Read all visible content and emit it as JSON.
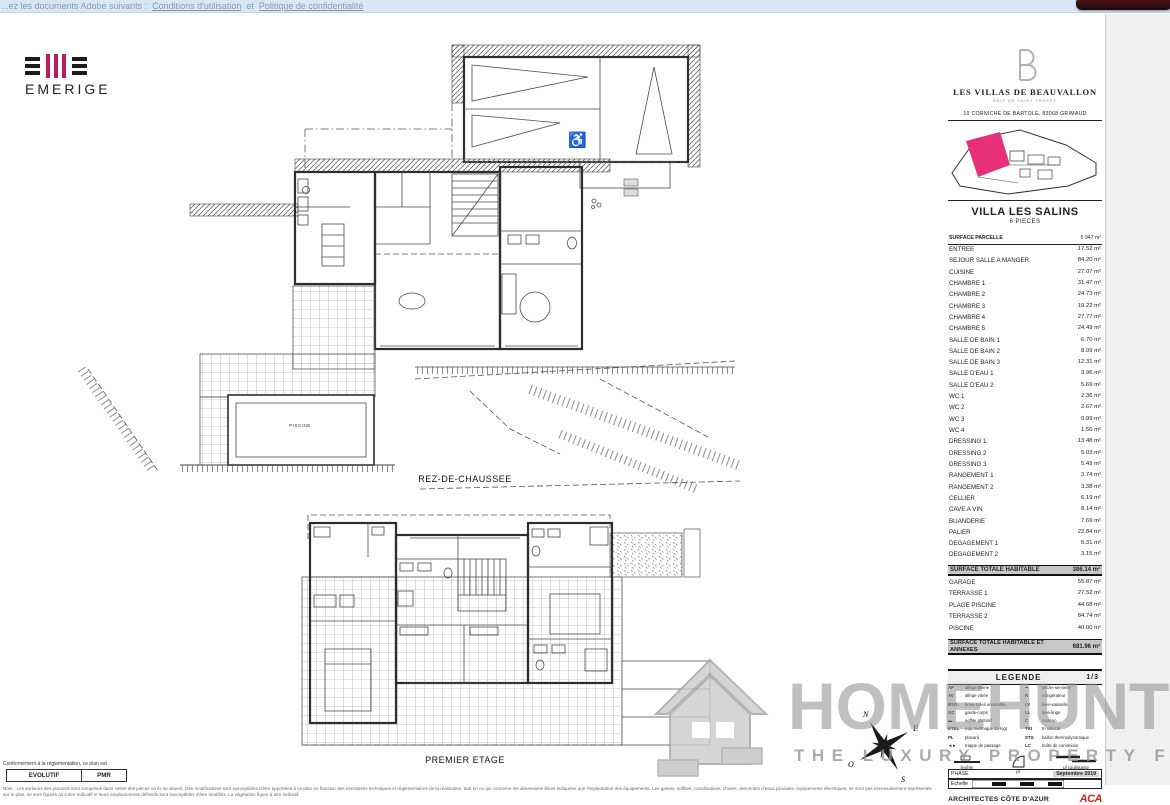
{
  "colors": {
    "accent_pink": "#c0195f",
    "lot_pink": "#e8307a",
    "watermark_gray": "#8c8c8c",
    "topbar_blue": "#d8e7f6",
    "aca_red": "#bc3026"
  },
  "browser_bar": {
    "prefix": "...ez les documents Adobe suivants :",
    "link1": "Conditions d'utilisation",
    "separator": "et",
    "link2": "Politique de confidentialité"
  },
  "emerige": {
    "name": "EMERIGE"
  },
  "plans": {
    "ground_floor_label": "REZ-DE-CHAUSSEE",
    "first_floor_label": "PREMIER ETAGE",
    "pool_label": "PISCINE",
    "compass_points": {
      "n": "N",
      "e": "E",
      "s": "S",
      "o": "O"
    }
  },
  "panel": {
    "brand": "LES VILLAS DE BEAUVALLON",
    "brand_sub": "BAIE DE SAINT TROPEZ",
    "address": "10 CORNICHE DE BARTOLE, 83068 GRIMAUD",
    "villa_name": "VILLA LES SALINS",
    "villa_type": "6 PIECES",
    "parcel": {
      "label": "SURFACE PARCELLE",
      "value": "5 947 m²"
    },
    "rooms": [
      {
        "label": "ENTREE",
        "value": "17.52 m²"
      },
      {
        "label": "SEJOUR SALLE A MANGER",
        "value": "84.20 m²"
      },
      {
        "label": "CUISINE",
        "value": "27.07 m²"
      },
      {
        "label": "CHAMBRE 1",
        "value": "31.47 m²"
      },
      {
        "label": "CHAMBRE 2",
        "value": "24.73 m²"
      },
      {
        "label": "CHAMBRE 3",
        "value": "19.22 m²"
      },
      {
        "label": "CHAMBRE 4",
        "value": "27.77 m²"
      },
      {
        "label": "CHAMBRE 5",
        "value": "24.49 m²"
      },
      {
        "label": "SALLE DE BAIN 1",
        "value": "6.70 m²"
      },
      {
        "label": "SALLE DE BAIN 2",
        "value": "8.09 m²"
      },
      {
        "label": "SALLE DE BAIN 3",
        "value": "12.31 m²"
      },
      {
        "label": "SALLE D'EAU 1",
        "value": "3.96 m²"
      },
      {
        "label": "SALLE D'EAU 2",
        "value": "5.69 m²"
      },
      {
        "label": "WC 1",
        "value": "2.36 m²"
      },
      {
        "label": "WC 2",
        "value": "2.67 m²"
      },
      {
        "label": "WC 3",
        "value": "0.99 m²"
      },
      {
        "label": "WC 4",
        "value": "1.56 m²"
      },
      {
        "label": "DRESSING 1",
        "value": "13.48 m²"
      },
      {
        "label": "DRESSING 2",
        "value": "5.03 m²"
      },
      {
        "label": "DRESSING 3",
        "value": "5.49 m²"
      },
      {
        "label": "RANGEMENT 1",
        "value": "3.74 m²"
      },
      {
        "label": "RANGEMENT 2",
        "value": "3.38 m²"
      },
      {
        "label": "CELLIER",
        "value": "6.19 m²"
      },
      {
        "label": "CAVE A VIN",
        "value": "8.14 m²"
      },
      {
        "label": "BUANDERIE",
        "value": "7.69 m²"
      },
      {
        "label": "PALIER",
        "value": "22.84 m²"
      },
      {
        "label": "DEGAGEMENT 1",
        "value": "5.31 m²"
      },
      {
        "label": "DEGAGEMENT 2",
        "value": "3.15 m²"
      }
    ],
    "total_habitable": {
      "label": "SURFACE TOTALE HABITABLE",
      "value": "386.14 m²"
    },
    "annexes": [
      {
        "label": "GARAGE",
        "value": "55.87 m²"
      },
      {
        "label": "TERRASSE 1",
        "value": "27.52 m²"
      },
      {
        "label": "PLAGE PISCINE",
        "value": "44.68 m²"
      },
      {
        "label": "TERRASSE 2",
        "value": "84.74 m²"
      },
      {
        "label": "PISCINE",
        "value": "40.00 m²"
      }
    ],
    "total_all": {
      "label": "SURFACE TOTALE HABITABLE ET ANNEXES",
      "value": "681.96 m²"
    },
    "legend": {
      "title": "LEGENDE",
      "page": "1/3",
      "left": [
        {
          "abbr": "AP",
          "label": "allège pleine"
        },
        {
          "abbr": "AV",
          "label": "allège vitrée"
        },
        {
          "abbr": "BSO",
          "label": "brise-soleil orientable"
        },
        {
          "abbr": "GC",
          "label": "garde-corps"
        },
        {
          "abbr": "▬",
          "label": "soffite plafond"
        },
        {
          "abbr": "ETEL",
          "label": "esp. technique du logt"
        },
        {
          "abbr": "PL",
          "label": "placard"
        },
        {
          "abbr": "◄►",
          "label": "trappe de passage"
        }
      ],
      "right": [
        {
          "abbr": "━",
          "label": "sèche-serviette"
        },
        {
          "abbr": "R",
          "label": "réfrigérateur"
        },
        {
          "abbr": "LV",
          "label": "lave-vaisselle"
        },
        {
          "abbr": "LL",
          "label": "lave-linge"
        },
        {
          "abbr": "C",
          "label": "cuisson"
        },
        {
          "abbr": "TRI",
          "label": "tri sélectif"
        },
        {
          "abbr": "STG",
          "label": "ballon thermodynamique"
        },
        {
          "abbr": "LC",
          "label": "boîte de connexion"
        }
      ],
      "symbols": [
        "fenêtre",
        "pf",
        "pf coulissante"
      ],
      "phase_label": "PHASE",
      "phase_value": "Septembre 2019",
      "scale_label": "Echelle",
      "architects": "ARCHITECTES CÔTE D'AZUR",
      "architects_logo": "ACA"
    }
  },
  "footer": {
    "conformity": "Conformément à la réglementation, ce plan est :",
    "evolutif": "EVOLUTIF",
    "pmr": "PMR",
    "disclaimer1": "Note : Les surfaces des placards sont comprises dans celles des pièces où ils se situent. Des modifications sont susceptibles d'être apportées à ce plan en fonction des nécessités techniques et réglementaires de la réalisation, tant en ce qui concerne les dimensions libres indiquées que l'implantation des équipements. Les gaines, soffites,",
    "disclaimer2": "canalisations, chutes, descentes d'eaux pluviales, équipements électriques, ne sont pas nécessairement représentés sur le plan, ne sont figurés qu'à titre indicatif et leurs emplacements définitifs sont susceptibles d'être modifiés. La végétation figure à titre indicatif."
  },
  "watermark": {
    "name": "HOMEHUNTS",
    "tagline": "THE LUXURY PROPERTY FINDERS"
  }
}
